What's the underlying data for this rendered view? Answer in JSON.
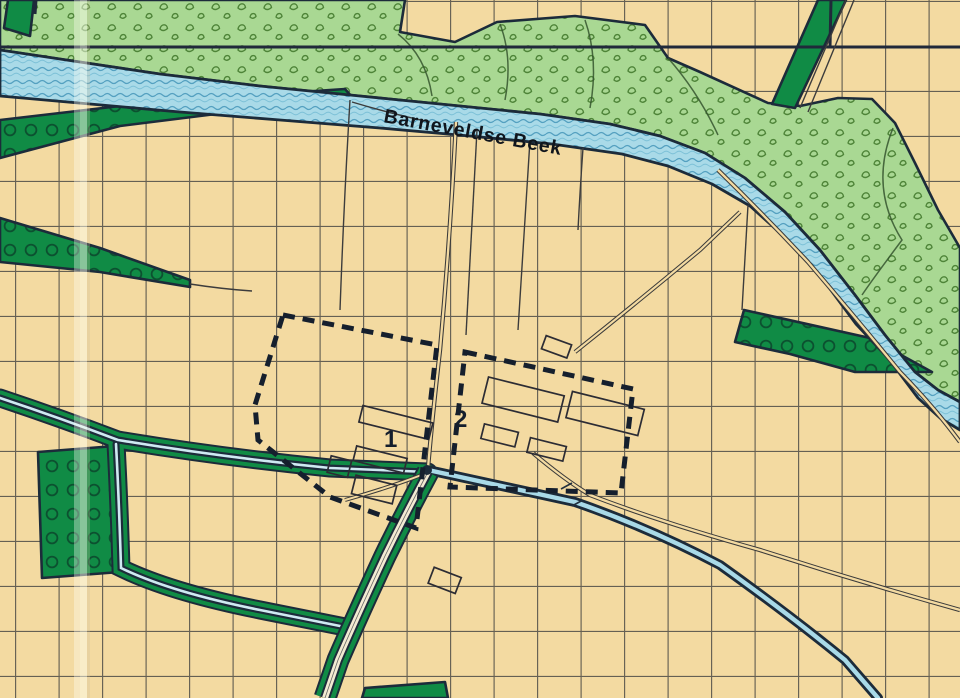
{
  "map": {
    "stream_label": "Barneveldse Beek",
    "site_markers": [
      {
        "label": "1"
      },
      {
        "label": "2"
      }
    ],
    "palette": {
      "paper": "#f3daa1",
      "grid_line": "#3d3d3d",
      "orchard_green": "#108b45",
      "orchard_ring": "#0c5130",
      "woodland_green": "#a9d893",
      "woodland_scribble": "#4e8438",
      "water_fill": "#a9dae8",
      "water_wave": "#54a0c0",
      "outline_navy": "#1c2b3a",
      "boundary_dash": "#151f2d",
      "building_outline": "#2c2c34",
      "road_line": "#3a3a3a"
    }
  }
}
